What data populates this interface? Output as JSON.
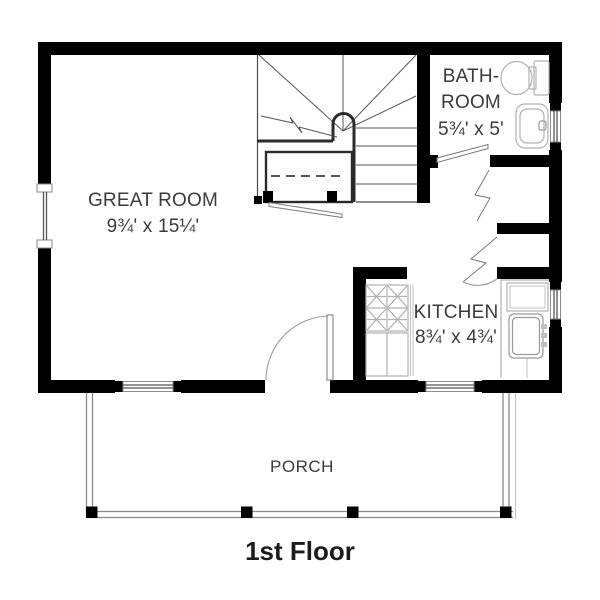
{
  "floor_plan": {
    "title": "1st Floor",
    "rooms": {
      "great_room": {
        "name": "GREAT ROOM",
        "dims": "9¾' x 15¼'"
      },
      "bathroom": {
        "name_line1": "BATH-",
        "name_line2": "ROOM",
        "dims": "5¾' x 5'"
      },
      "kitchen": {
        "name": "KITCHEN",
        "dims": "8¾' x 4¾'"
      },
      "porch": {
        "name": "PORCH"
      }
    },
    "fixtures": [
      "stairs-icon",
      "toilet-icon",
      "bathroom-sink-icon",
      "stove-icon",
      "kitchen-sink-icon",
      "kitchen-counter-icon",
      "entry-door-swing-icon",
      "bathroom-door-icon",
      "bifold-closet-door-icon",
      "under-stair-closet-icon",
      "window-icon",
      "porch-railing-icon"
    ],
    "colors": {
      "wall": "#000000",
      "thin_line": "#4a4a4a",
      "fixture_line": "#b0b0b0",
      "door_line": "#777777",
      "text": "#3a3a3a",
      "title_text": "#1c1c1c",
      "background": "#ffffff"
    }
  }
}
